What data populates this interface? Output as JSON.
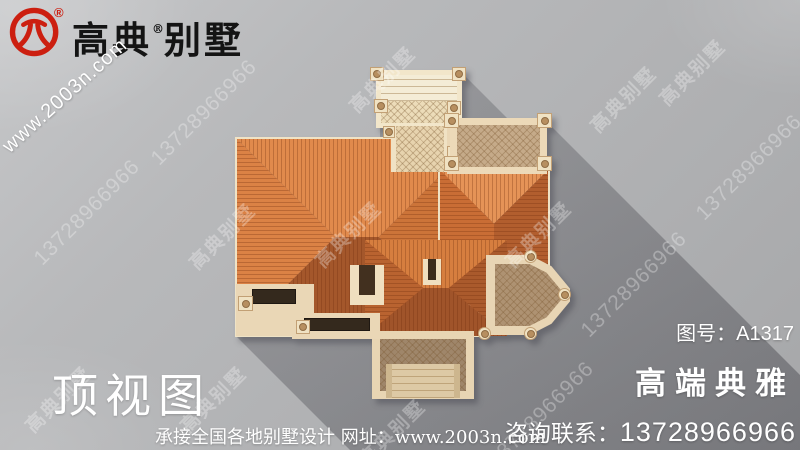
{
  "brand": {
    "name_part1": "高典",
    "name_part2": "别墅",
    "registered": "®",
    "url": "www.2003n.com"
  },
  "labels": {
    "view_title": "顶视图",
    "drawing_no_label": "图号：",
    "drawing_no_value": "A1317",
    "tagline": "高端典雅",
    "contact_label": "咨询联系：",
    "contact_phone": "13728966966",
    "footer_service": "承接全国各地别墅设计",
    "footer_url_label": "网址：",
    "footer_url": "www.2003n.com"
  },
  "watermarks": {
    "brand": "高典别墅",
    "phone": "13728966966"
  },
  "render": {
    "subject": "villa-top-view",
    "roof_color_light": "#e18a4c",
    "roof_color_dark": "#a4572b",
    "wall_color": "#ead7b6",
    "background_color": "#b3b4b6",
    "shadow_color": "#9b9b9d",
    "logo_color": "#cc1f10"
  }
}
